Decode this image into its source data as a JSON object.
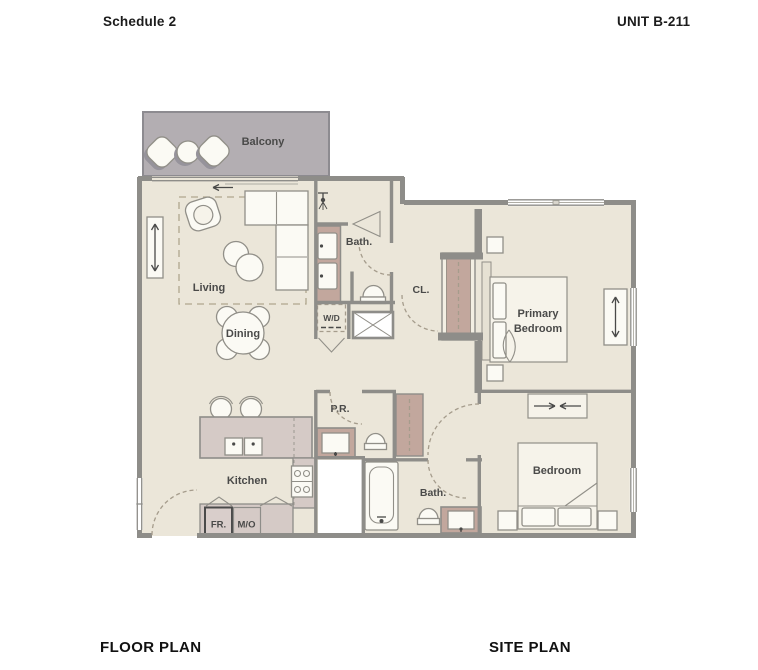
{
  "header": {
    "schedule_label": "Schedule 2",
    "unit_label": "UNIT B-211"
  },
  "footer": {
    "floor_plan_label": "FLOOR PLAN",
    "site_plan_label": "SITE PLAN"
  },
  "plan_labels": {
    "balcony": "Balcony",
    "living": "Living",
    "dining": "Dining",
    "bath_upper": "Bath.",
    "closet": "CL.",
    "washer_dryer": "W/D",
    "primary_bedroom_line1": "Primary",
    "primary_bedroom_line2": "Bedroom",
    "powder_room": "P.R.",
    "kitchen": "Kitchen",
    "fridge": "FR.",
    "microwave_oven": "M/O",
    "bath_lower": "Bath.",
    "bedroom": "Bedroom"
  },
  "colors": {
    "floor": "#ebe6d9",
    "balcony": "#b3aeb2",
    "wall": "#8e8d89",
    "cabinet": "#c2a79d",
    "counter": "#d5cac6",
    "furniture": "#fbfaf4",
    "label_text": "#4a4a49"
  }
}
